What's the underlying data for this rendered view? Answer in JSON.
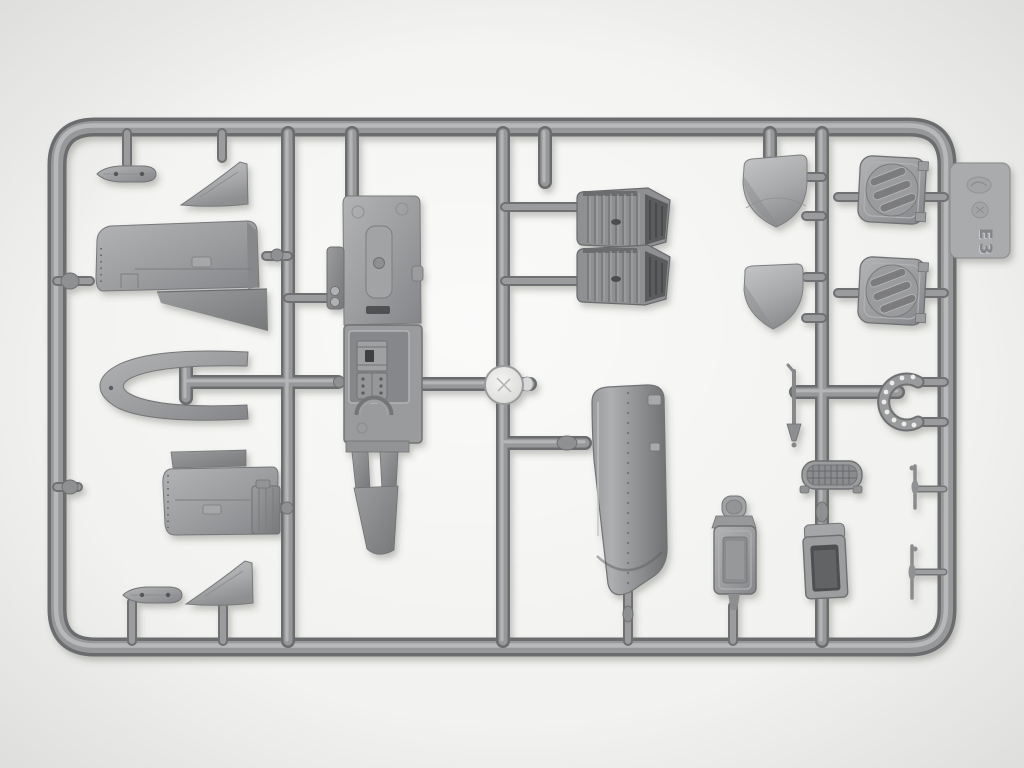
{
  "scene": {
    "type": "photograph",
    "subject": "Gray injection-molded plastic model-kit sprue (aircraft parts) on a white background",
    "background_color": "#f2f2f0",
    "plastic_color": "#9b9c9e",
    "runner_dark_color": "#6b6c6e",
    "runner_mid_color": "#97989a",
    "highlight_color": "#bcbdbe"
  },
  "sprue": {
    "tab_code": "E3",
    "tab_marks": [
      "oval-logo-emboss",
      "circular-material-mark"
    ],
    "parts": [
      "small-fairing-top-left",
      "triangular-panel-top-left",
      "wing-half-upper",
      "wingtip-bow",
      "wing-half-lower",
      "fuselage-half-with-cockpit",
      "radiator-block-1",
      "radiator-block-2",
      "sprue-gate-disc",
      "fuel-tank-shell",
      "dome-cover-large",
      "dome-cover-small",
      "louvered-panel-1",
      "louvered-panel-2",
      "perforated-curved-bracket",
      "control-stick",
      "mesh-grille",
      "open-box",
      "pilot-seat",
      "rod-1",
      "rod-2",
      "small-fairing-bottom-left",
      "triangular-panel-bottom-left"
    ]
  }
}
